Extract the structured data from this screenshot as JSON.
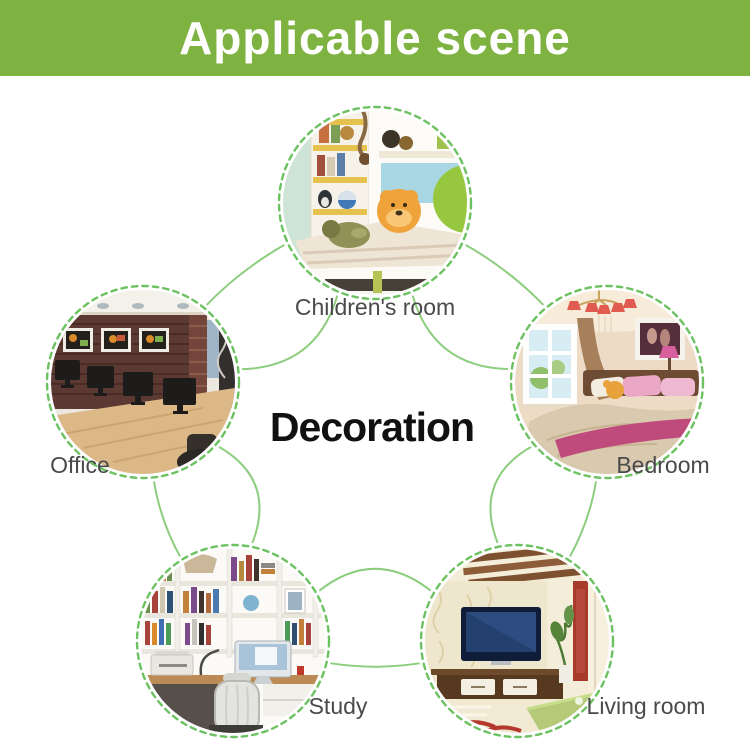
{
  "header": {
    "title": "Applicable scene"
  },
  "center": {
    "title": "Decoration"
  },
  "scenes": [
    {
      "id": "childrens-room",
      "label": "Children's room"
    },
    {
      "id": "office",
      "label": "Office"
    },
    {
      "id": "bedroom",
      "label": "Bedroom"
    },
    {
      "id": "study",
      "label": "Study"
    },
    {
      "id": "living-room",
      "label": "Living room"
    }
  ],
  "colors": {
    "banner_green": "#7fb341",
    "line_green": "#6cc161",
    "arc_green": "#8ccd7e",
    "label_gray": "#4a4a4a",
    "title_black": "#111111"
  }
}
